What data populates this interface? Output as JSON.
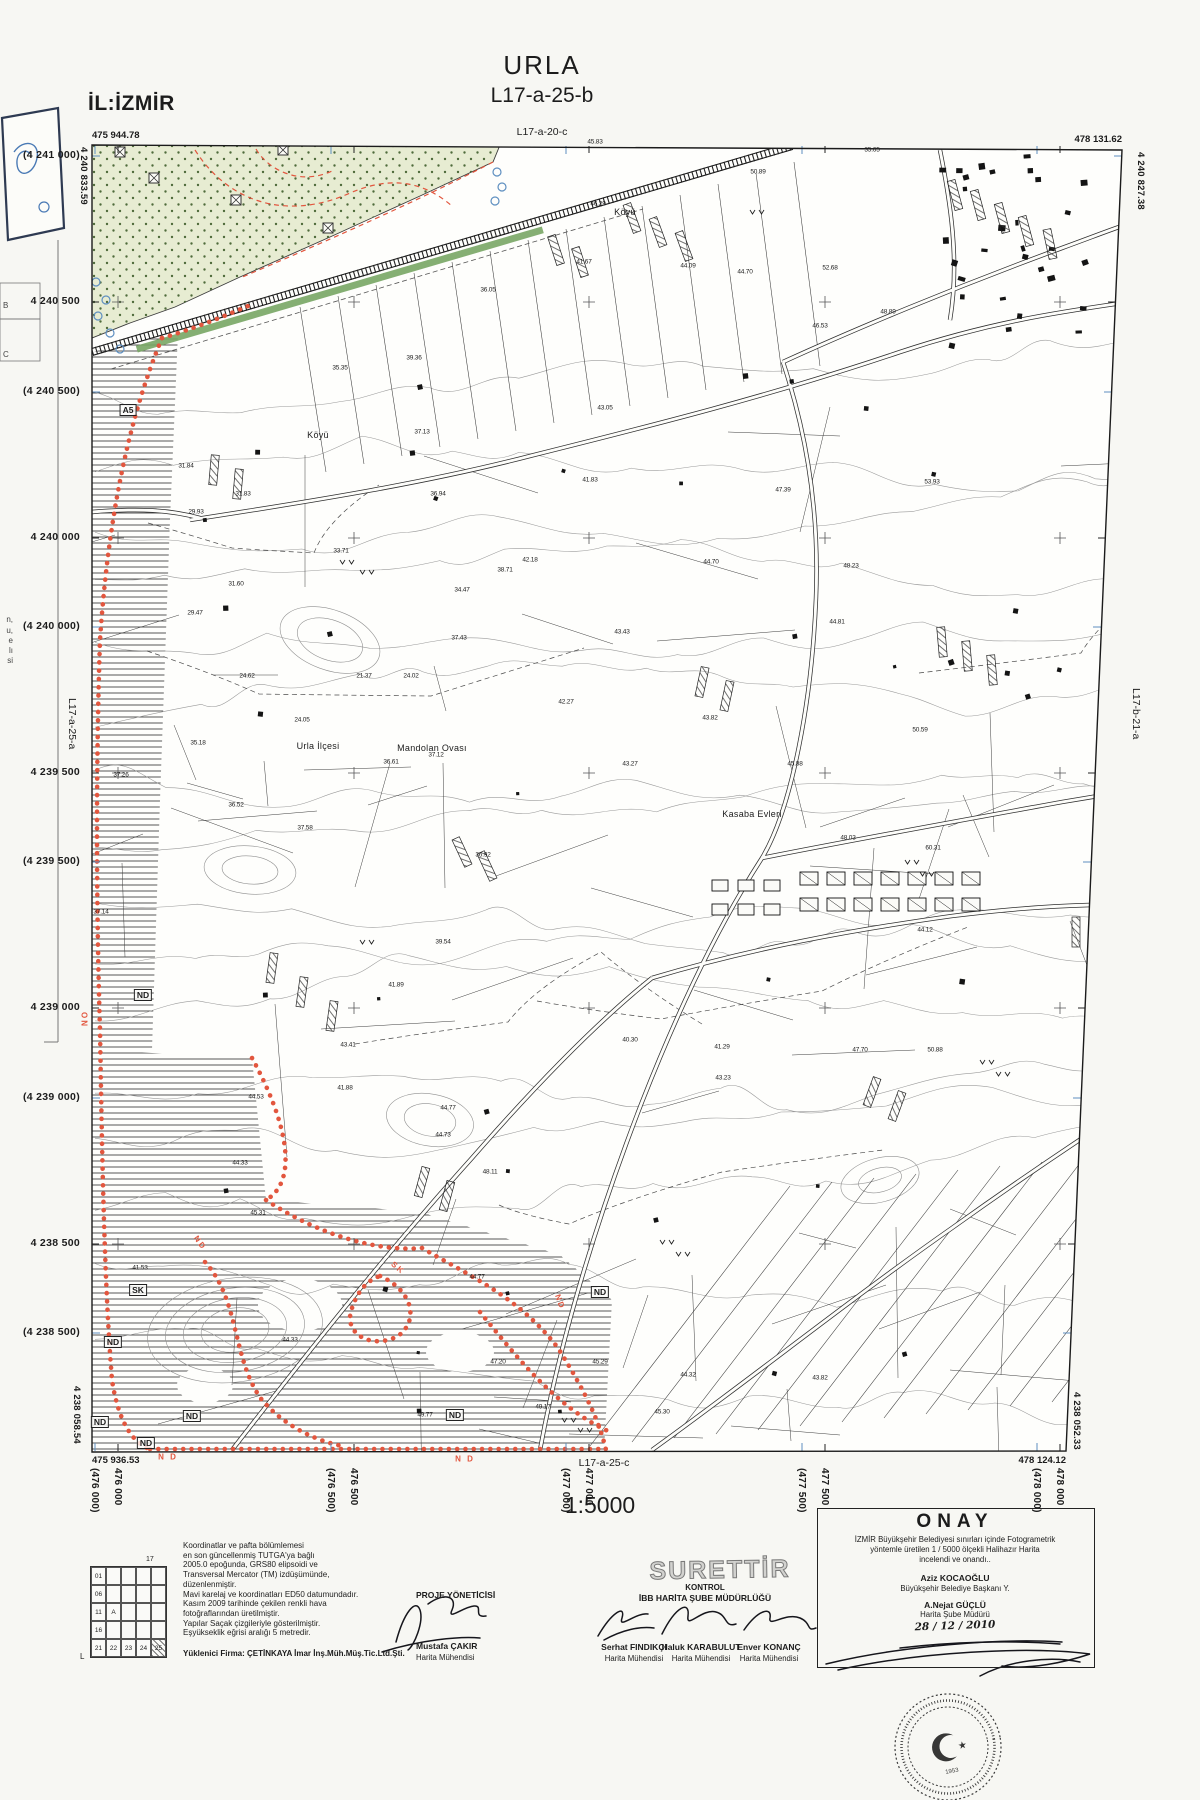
{
  "colors": {
    "boundary_red": "#e2563e",
    "green_area": "#e7ecd2",
    "green_dots": "#4f6b3b",
    "rail_green": "#79a765",
    "blue": "#5e8fc0",
    "ink": "#1b1b1b"
  },
  "header": {
    "province": "İL:İZMİR",
    "title": "URLA",
    "sheet": "L17-a-25-b",
    "north_sheet": "L17-a-20-c"
  },
  "south_sheet": "L17-a-25-c",
  "scale": "1:5000",
  "corners": {
    "tl_e": "475 944.78",
    "tl_n": "4 240 833.59",
    "tr_e": "478 131.62",
    "tr_n": "4 240 827.38",
    "bl_e": "475 936.53",
    "bl_n": "4 238 058.54",
    "br_e": "478 124.12",
    "br_n": "4 238 052.33"
  },
  "verticals": [
    {
      "t": "4 240 833.59",
      "x": 89,
      "y": 147,
      "c": "vcoord"
    },
    {
      "t": "4 240 827.38",
      "x": 1146,
      "y": 152,
      "c": "vcoord"
    },
    {
      "t": "4 238 058.54",
      "x": 82,
      "y": 1386,
      "c": "vcoord"
    },
    {
      "t": "4 238 052.33",
      "x": 1082,
      "y": 1392,
      "c": "vcoord"
    },
    {
      "t": "L17-a-25-a",
      "x": 78,
      "y": 698,
      "c": "vsheet"
    },
    {
      "t": "L17-b-21-a",
      "x": 1142,
      "y": 688,
      "c": "vsheet"
    }
  ],
  "margins": {
    "left": [
      {
        "t": "(4 241 000)",
        "y": 156
      },
      {
        "t": "4 240 500",
        "y": 302
      },
      {
        "t": "(4 240 500)",
        "y": 392
      },
      {
        "t": "4 240 000",
        "y": 538
      },
      {
        "t": "(4 240 000)",
        "y": 627
      },
      {
        "t": "4 239 500",
        "y": 773
      },
      {
        "t": "(4 239 500)",
        "y": 862
      },
      {
        "t": "4 239 000",
        "y": 1008
      },
      {
        "t": "(4 239 000)",
        "y": 1098
      },
      {
        "t": "4 238 500",
        "y": 1244
      },
      {
        "t": "(4 238 500)",
        "y": 1333
      }
    ],
    "bottom": [
      {
        "t": "(476 000)",
        "x": 95
      },
      {
        "t": "476 000",
        "x": 118
      },
      {
        "t": "(476 500)",
        "x": 331
      },
      {
        "t": "476 500",
        "x": 354
      },
      {
        "t": "(477 000)",
        "x": 566
      },
      {
        "t": "477 000",
        "x": 589
      },
      {
        "t": "(477 500)",
        "x": 802
      },
      {
        "t": "477 500",
        "x": 825
      },
      {
        "t": "(478 000)",
        "x": 1037
      },
      {
        "t": "478 000",
        "x": 1060
      }
    ]
  },
  "map": {
    "place_labels": [
      {
        "t": "Urla İlçesi",
        "x": 318,
        "y": 746
      },
      {
        "t": "Mandolan Ovası",
        "x": 432,
        "y": 748
      },
      {
        "t": "Kasaba Evleri",
        "x": 752,
        "y": 814
      },
      {
        "t": "Köyü",
        "x": 625,
        "y": 212
      },
      {
        "t": "Köyü",
        "x": 318,
        "y": 435
      }
    ],
    "zone_boxes": [
      [
        128,
        410,
        "A5"
      ],
      [
        143,
        995,
        "ND"
      ],
      [
        138,
        1290,
        "SK"
      ],
      [
        113,
        1342,
        "ND"
      ],
      [
        100,
        1422,
        "ND"
      ],
      [
        192,
        1416,
        "ND"
      ],
      [
        146,
        1443,
        "ND"
      ],
      [
        455,
        1415,
        "ND"
      ],
      [
        600,
        1292,
        "ND"
      ]
    ],
    "red_marks": [
      {
        "t": "ND",
        "x": 200,
        "y": 1243,
        "r": 55
      },
      {
        "t": "N D",
        "x": 168,
        "y": 1457,
        "r": 0
      },
      {
        "t": "N D",
        "x": 465,
        "y": 1459,
        "r": 0
      },
      {
        "t": "ON",
        "x": 84,
        "y": 1020,
        "r": 90
      },
      {
        "t": "SK",
        "x": 398,
        "y": 1268,
        "r": 40
      },
      {
        "t": "ND",
        "x": 560,
        "y": 1302,
        "r": 70
      }
    ],
    "spot_heights": [
      [
        595,
        142,
        "45.83"
      ],
      [
        872,
        150,
        "35.65"
      ],
      [
        758,
        172,
        "50.89"
      ],
      [
        598,
        204,
        "46.29"
      ],
      [
        688,
        266,
        "44.09"
      ],
      [
        584,
        262,
        "41.67"
      ],
      [
        830,
        268,
        "52.68"
      ],
      [
        745,
        272,
        "44.70"
      ],
      [
        888,
        312,
        "48.89"
      ],
      [
        820,
        326,
        "46.53"
      ],
      [
        488,
        290,
        "36.05"
      ],
      [
        414,
        358,
        "39.36"
      ],
      [
        340,
        368,
        "35.35"
      ],
      [
        605,
        408,
        "43.05"
      ],
      [
        422,
        432,
        "37.13"
      ],
      [
        590,
        480,
        "41.83"
      ],
      [
        783,
        490,
        "47.39"
      ],
      [
        932,
        482,
        "53.93"
      ],
      [
        186,
        466,
        "31.84"
      ],
      [
        243,
        494,
        "31.83"
      ],
      [
        196,
        512,
        "29.93"
      ],
      [
        438,
        494,
        "36.94"
      ],
      [
        341,
        551,
        "33.71"
      ],
      [
        530,
        560,
        "42.18"
      ],
      [
        711,
        562,
        "44.70"
      ],
      [
        851,
        566,
        "48.23"
      ],
      [
        505,
        570,
        "38.71"
      ],
      [
        236,
        584,
        "31.60"
      ],
      [
        462,
        590,
        "34.47"
      ],
      [
        195,
        613,
        "29.47"
      ],
      [
        459,
        638,
        "37.43"
      ],
      [
        622,
        632,
        "43.43"
      ],
      [
        837,
        622,
        "44.81"
      ],
      [
        247,
        676,
        "24.62"
      ],
      [
        364,
        676,
        "21.37"
      ],
      [
        411,
        676,
        "24.02"
      ],
      [
        566,
        702,
        "42.27"
      ],
      [
        710,
        718,
        "43.82"
      ],
      [
        920,
        730,
        "50.59"
      ],
      [
        302,
        720,
        "24.05"
      ],
      [
        198,
        743,
        "35.18"
      ],
      [
        121,
        775,
        "37.26"
      ],
      [
        391,
        762,
        "36.61"
      ],
      [
        436,
        755,
        "37.12"
      ],
      [
        630,
        764,
        "43.27"
      ],
      [
        795,
        764,
        "45.88"
      ],
      [
        848,
        838,
        "48.03"
      ],
      [
        236,
        805,
        "36.52"
      ],
      [
        305,
        828,
        "37.58"
      ],
      [
        483,
        855,
        "36.92"
      ],
      [
        933,
        848,
        "60.31"
      ],
      [
        101,
        912,
        "37.14"
      ],
      [
        443,
        942,
        "39.54"
      ],
      [
        396,
        985,
        "41.89"
      ],
      [
        348,
        1045,
        "43.41"
      ],
      [
        630,
        1040,
        "40.30"
      ],
      [
        722,
        1047,
        "41.29"
      ],
      [
        860,
        1050,
        "47.70"
      ],
      [
        935,
        1050,
        "50.88"
      ],
      [
        723,
        1078,
        "43.23"
      ],
      [
        256,
        1097,
        "44.53"
      ],
      [
        345,
        1088,
        "41.88"
      ],
      [
        448,
        1108,
        "44.77"
      ],
      [
        443,
        1135,
        "44.73"
      ],
      [
        240,
        1163,
        "44.33"
      ],
      [
        490,
        1172,
        "48.11"
      ],
      [
        258,
        1213,
        "45.31"
      ],
      [
        140,
        1268,
        "41.53"
      ],
      [
        290,
        1340,
        "44.33"
      ],
      [
        477,
        1277,
        "44.77"
      ],
      [
        498,
        1362,
        "47.20"
      ],
      [
        600,
        1362,
        "45.29"
      ],
      [
        543,
        1407,
        "49.17"
      ],
      [
        425,
        1415,
        "49.77"
      ],
      [
        688,
        1375,
        "44.32"
      ],
      [
        662,
        1412,
        "45.30"
      ],
      [
        820,
        1378,
        "43.82"
      ],
      [
        925,
        930,
        "44.12"
      ]
    ]
  },
  "sliver": {
    "letters": [
      {
        "t": "B",
        "y": 306
      },
      {
        "t": "C",
        "y": 355
      }
    ],
    "frags": [
      {
        "t": "n,",
        "y": 620
      },
      {
        "t": "u,",
        "y": 631
      },
      {
        "t": "e",
        "y": 641
      },
      {
        "t": "lı",
        "y": 651
      },
      {
        "t": "si",
        "y": 661
      }
    ]
  },
  "legend": {
    "corner": "17",
    "origin": "L",
    "rows": [
      [
        "01",
        "",
        "",
        "",
        ""
      ],
      [
        "06",
        "",
        "",
        "",
        ""
      ],
      [
        "11",
        "A",
        "",
        "",
        ""
      ],
      [
        "16",
        "",
        "",
        "",
        ""
      ],
      [
        "21",
        "22",
        "23",
        "24",
        "25"
      ]
    ],
    "hatched": [
      4,
      4
    ],
    "notes": [
      "Koordinatlar ve pafta bölümlemesi",
      "en son güncellenmiş TUTGA'ya bağlı",
      "2005.0 epoğunda, GRS80 elipsoidi ve",
      "Transversal Mercator (TM) izdüşümünde,",
      "düzenlenmiştir.",
      "Mavi karelaj ve koordinatları ED50 datumundadır.",
      "Kasım  2009 tarihinde çekilen renkli hava",
      "fotoğraflarından üretilmiştir.",
      "Yapılar Saçak çizgileriyle gösterilmiştir.",
      "Eşyükseklik eğrisi aralığı 5 metredir."
    ],
    "contractor": "Yüklenici Firma: ÇETİNKAYA İmar İnş.Müh.Müş.Tic.Ltd.Şti."
  },
  "proje": {
    "title": "PROJE YÖNETİCİSİ",
    "name": "Mustafa ÇAKIR",
    "role": "Harita Mühendisi"
  },
  "kontrol": {
    "stamp": "SURETTİR",
    "label": "KONTROL",
    "org": "İBB HARİTA ŞUBE MÜDÜRLÜĞÜ",
    "people": [
      {
        "name": "Serhat FINDIKÇI",
        "role": "Harita Mühendisi"
      },
      {
        "name": "Haluk KARABULUT",
        "role": "Harita Mühendisi"
      },
      {
        "name": "Enver KONANÇ",
        "role": "Harita Mühendisi"
      }
    ]
  },
  "onay": {
    "title": "ONAY",
    "line1": "İZMİR  Büyükşehir Belediyesi sınırları içinde  Fotogrametrik",
    "line2": "yöntemle üretilen 1 / 5000 ölçekli Halihazır Harita",
    "line3": "incelendi ve onandı..",
    "name1": "Aziz KOCAOĞLU",
    "role1": "Büyükşehir Belediye Başkanı Y.",
    "name2": "A.Nejat GÜÇLÜ",
    "role2": "Harita Şube Müdürü",
    "date": "28 / 12 / 2010",
    "seal_year": "1953"
  }
}
